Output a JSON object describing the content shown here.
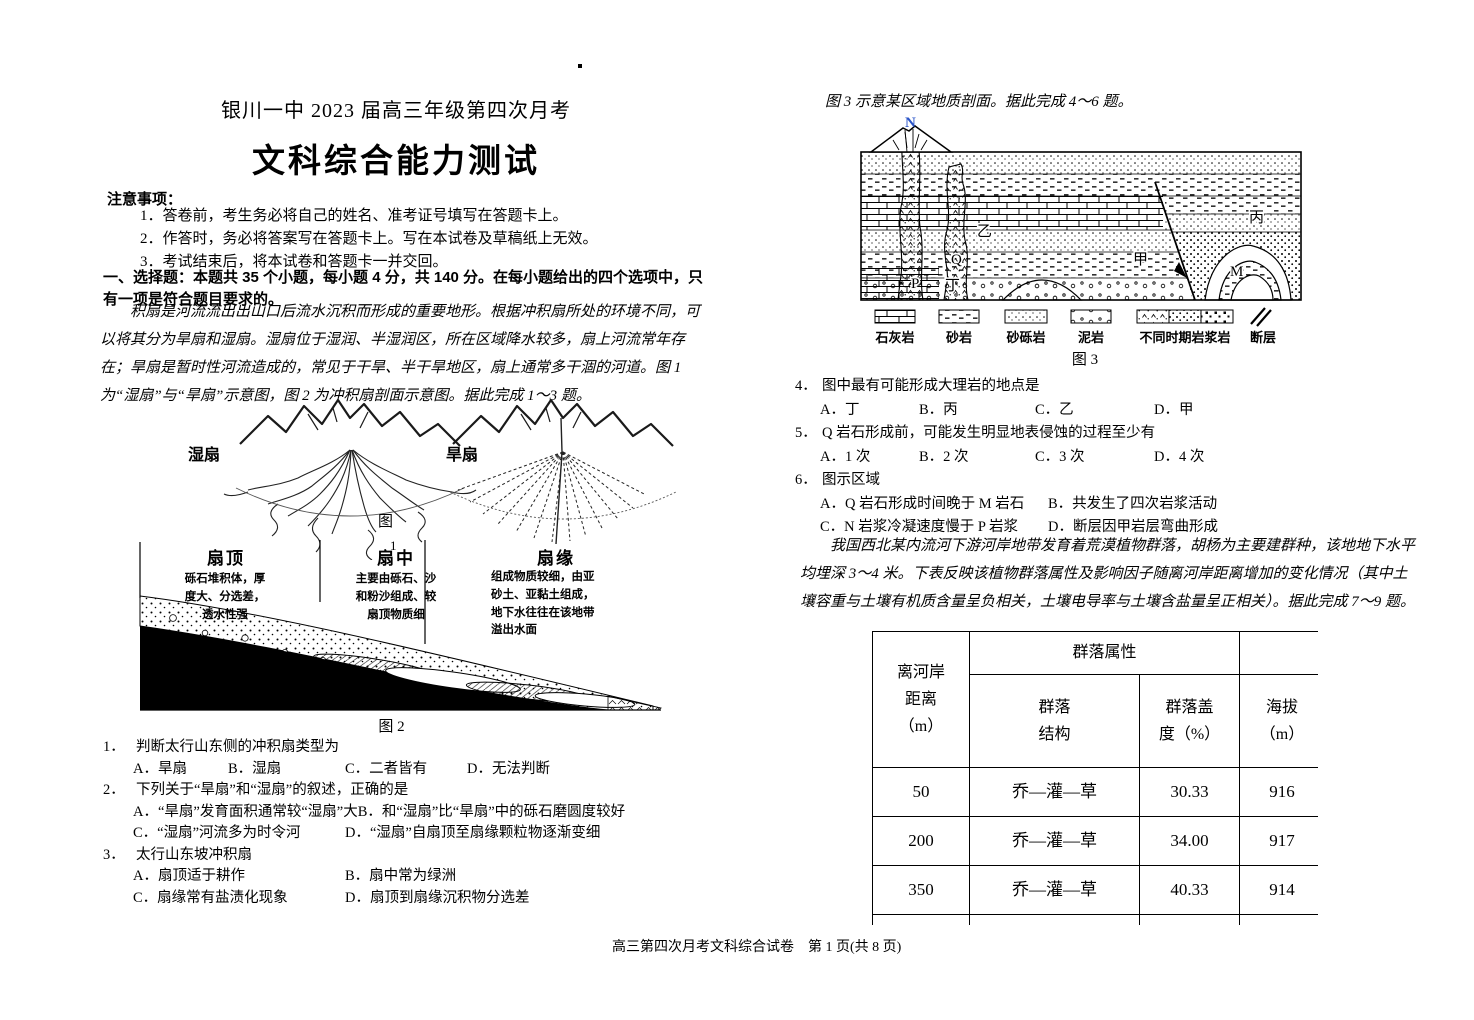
{
  "page": {
    "header_line": "银川一中 2023 届高三年级第四次月考",
    "title": "文科综合能力测试",
    "footer": "高三第四次月考文科综合试卷　第 1 页(共 8 页)"
  },
  "notices": {
    "heading": "注意事项：",
    "items": [
      "1．答卷前，考生务必将自己的姓名、准考证号填写在答题卡上。",
      "2．作答时，务必将答案写在答题卡上。写在本试卷及草稿纸上无效。",
      "3．考试结束后，将本试卷和答题卡一并交回。"
    ]
  },
  "section": {
    "heading": "一、选择题：本题共 35 个小题，每小题 4 分，共 140 分。在每小题给出的四个选项中，只有一项是符合题目要求的。"
  },
  "passages": {
    "p1": "积扇是河流流出出山口后流水沉积而形成的重要地形。根据冲积扇所处的环境不同，可以将其分为旱扇和湿扇。湿扇位于湿润、半湿润区，所在区域降水较多，扇上河流常年存在；旱扇是暂时性河流造成的，常见于干旱、半干旱地区，扇上通常多干涸的河道。图 1 为“湿扇”与“旱扇”示意图，图 2 为冲积扇剖面示意图。据此完成 1～3 题。",
    "p2": "我国西北某内流河下游河岸地带发育着荒漠植物群落，胡杨为主要建群种，该地地下水平均埋深 3～4 米。下表反映该植物群落属性及影响因子随离河岸距离增加的变化情况（其中土壤容重与土壤有机质含量呈负相关，土壤电导率与土壤含盐量呈正相关）。据此完成 7～9 题。"
  },
  "figure1": {
    "wet_label": "湿扇",
    "dry_label": "旱扇",
    "caption_char": "图",
    "caption_num": "1"
  },
  "figure2": {
    "zones": [
      {
        "title": "扇顶",
        "desc": "砾石堆积体，厚\n度大、分选差，\n透水性强"
      },
      {
        "title": "扇中",
        "desc": "主要由砾石、沙\n和粉沙组成、较\n扇顶物质细"
      },
      {
        "title": "扇缘",
        "desc": "组成物质较细，由亚\n砂土、亚黏土组成，\n地下水往往在该地带\n溢出水面"
      }
    ],
    "caption": "图 2"
  },
  "figure3": {
    "lead": "图 3 示意某区域地质剖面。据此完成 4～6 题。",
    "north": "N",
    "labels": {
      "p": "P",
      "q": "Q",
      "ding": "丁",
      "yi": "乙",
      "jia": "甲",
      "m": "M",
      "bing": "丙"
    },
    "legend": [
      "石灰岩",
      "砂岩",
      "砂砾岩",
      "泥岩",
      "不同时期岩浆岩",
      "断层"
    ],
    "caption": "图 3",
    "north_colors": {
      "blue": "#2b55c8",
      "orange": "#e8a020"
    }
  },
  "questions": [
    {
      "num": "1．",
      "stem": "判断太行山东侧的冲积扇类型为",
      "options": [
        "A．旱扇",
        "B．湿扇",
        "C．二者皆有",
        "D．无法判断"
      ]
    },
    {
      "num": "2．",
      "stem": "下列关于“旱扇”和“湿扇”的叙述，正确的是",
      "options": [
        "A．“旱扇”发育面积通常较“湿扇”大",
        "B．和“湿扇”比“旱扇”中的砾石磨圆度较好",
        "C．“湿扇”河流多为时令河",
        "D．“湿扇”自扇顶至扇缘颗粒物逐渐变细"
      ]
    },
    {
      "num": "3．",
      "stem": "太行山东坡冲积扇",
      "options": [
        "A．扇顶适于耕作",
        "B．扇中常为绿洲",
        "C．扇缘常有盐渍化现象",
        "D．扇顶到扇缘沉积物分选差"
      ]
    },
    {
      "num": "4．",
      "stem": "图中最有可能形成大理岩的地点是",
      "options": [
        "A．丁",
        "B．丙",
        "C．乙",
        "D．甲"
      ]
    },
    {
      "num": "5．",
      "stem": "Q 岩石形成前，可能发生明显地表侵蚀的过程至少有",
      "options": [
        "A．1 次",
        "B．2 次",
        "C．3 次",
        "D．4 次"
      ]
    },
    {
      "num": "6．",
      "stem": "图示区域",
      "options": [
        "A．Q 岩石形成时间晚于 M 岩石",
        "B．共发生了四次岩浆活动",
        "C．N 岩浆冷凝速度慢于 P 岩浆",
        "D．断层因甲岩层弯曲形成"
      ]
    }
  ],
  "table": {
    "header": {
      "col1": "离河岸\n距离\n（m）",
      "group": "群落属性",
      "sub": [
        "群落\n结构",
        "群落盖\n度（%）",
        "海拔\n（m）"
      ]
    },
    "rows": [
      [
        "50",
        "乔—灌—草",
        "30.33",
        "916"
      ],
      [
        "200",
        "乔—灌—草",
        "34.00",
        "917"
      ],
      [
        "350",
        "乔—灌—草",
        "40.33",
        "914"
      ]
    ]
  }
}
